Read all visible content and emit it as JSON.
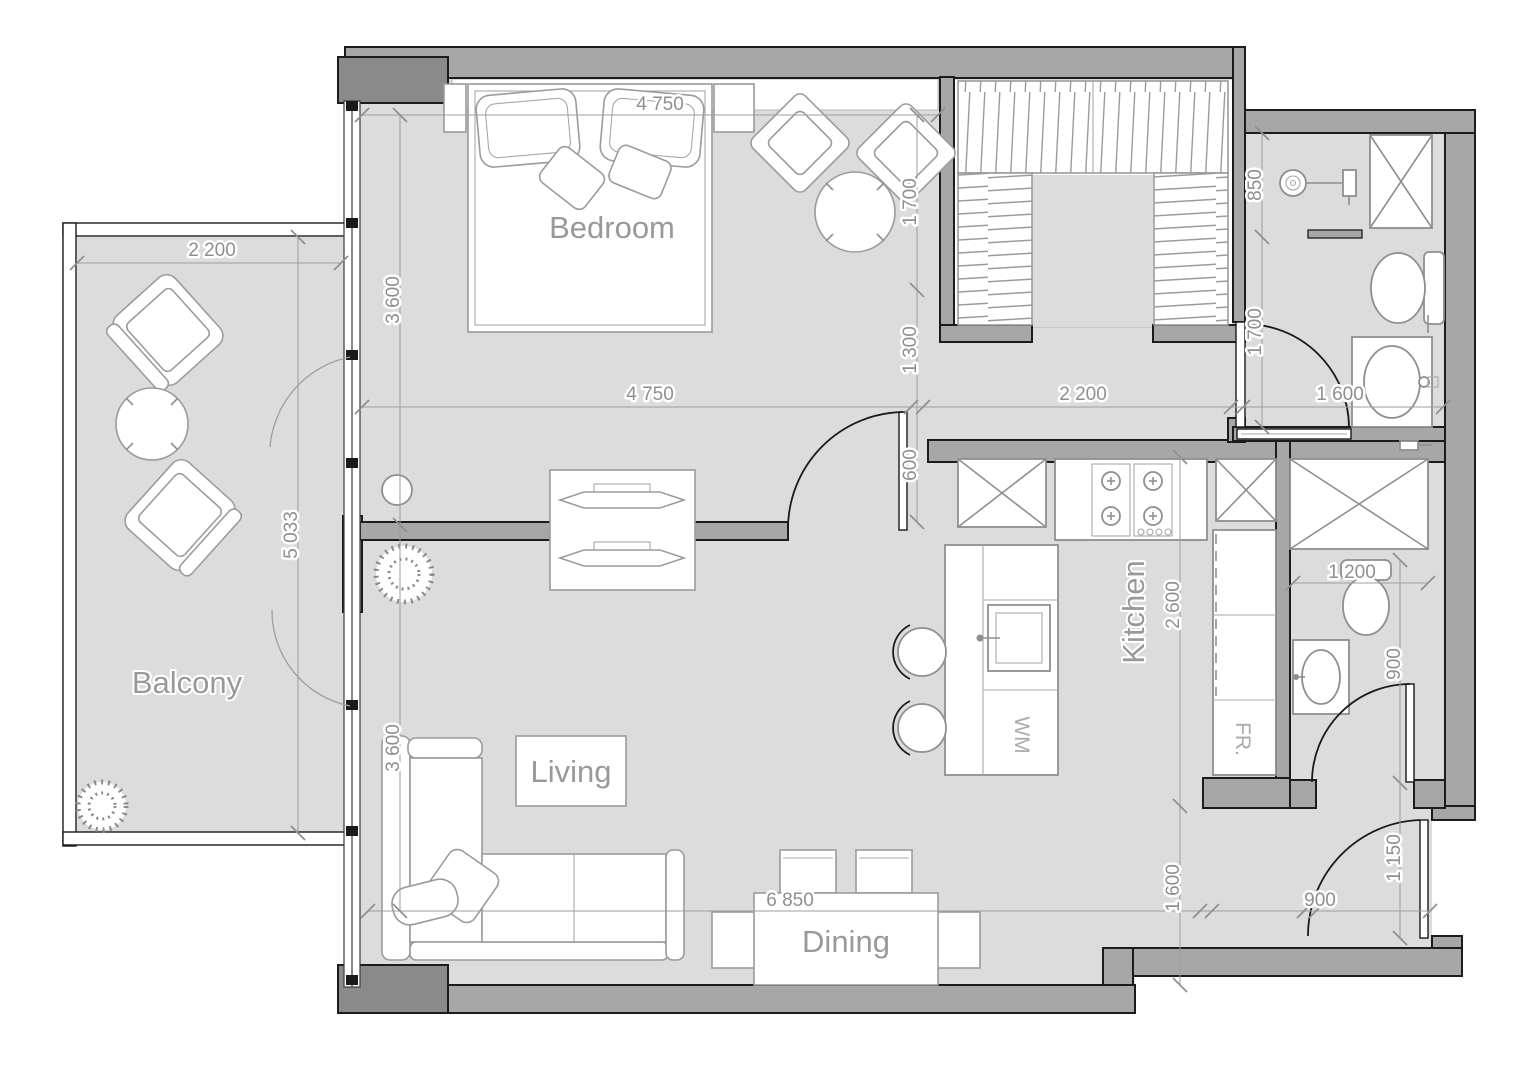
{
  "title": "Apartment floor plan",
  "rooms": {
    "bedroom": "Bedroom",
    "balcony": "Balcony",
    "living": "Living",
    "kitchen": "Kitchen",
    "dining": "Dining"
  },
  "appliances": {
    "washing_machine": "WM",
    "fridge": "FR."
  },
  "dimensions": {
    "bedroom_width_top": "4 750",
    "bedroom_width": "4 750",
    "balcony_width": "2 200",
    "balcony_length": "5 033",
    "bedroom_depth": "3 600",
    "living_depth": "3 600",
    "bedroom_sitting": "1 700",
    "corridor_a": "1 300",
    "corridor_b": "600",
    "hall_width": "2 200",
    "bath_width": "1 600",
    "closet_depth": "850",
    "bath_length": "1 700",
    "kitchen_length": "2 600",
    "kitchen_lower": "1 600",
    "wc_width": "1 200",
    "wc_depth": "900",
    "entry_depth": "1 150",
    "entry_width": "900",
    "total_width": "6 850"
  },
  "colors": {
    "background": "#ffffff",
    "wall": "#a7a7a7",
    "column": "#8a8a8a",
    "floor": "#dcdcdc",
    "outline": "#1c1c1c",
    "furniture_stroke": "#9b9b9b",
    "dimension": "#8f8f8f",
    "room_label": "#999999"
  }
}
